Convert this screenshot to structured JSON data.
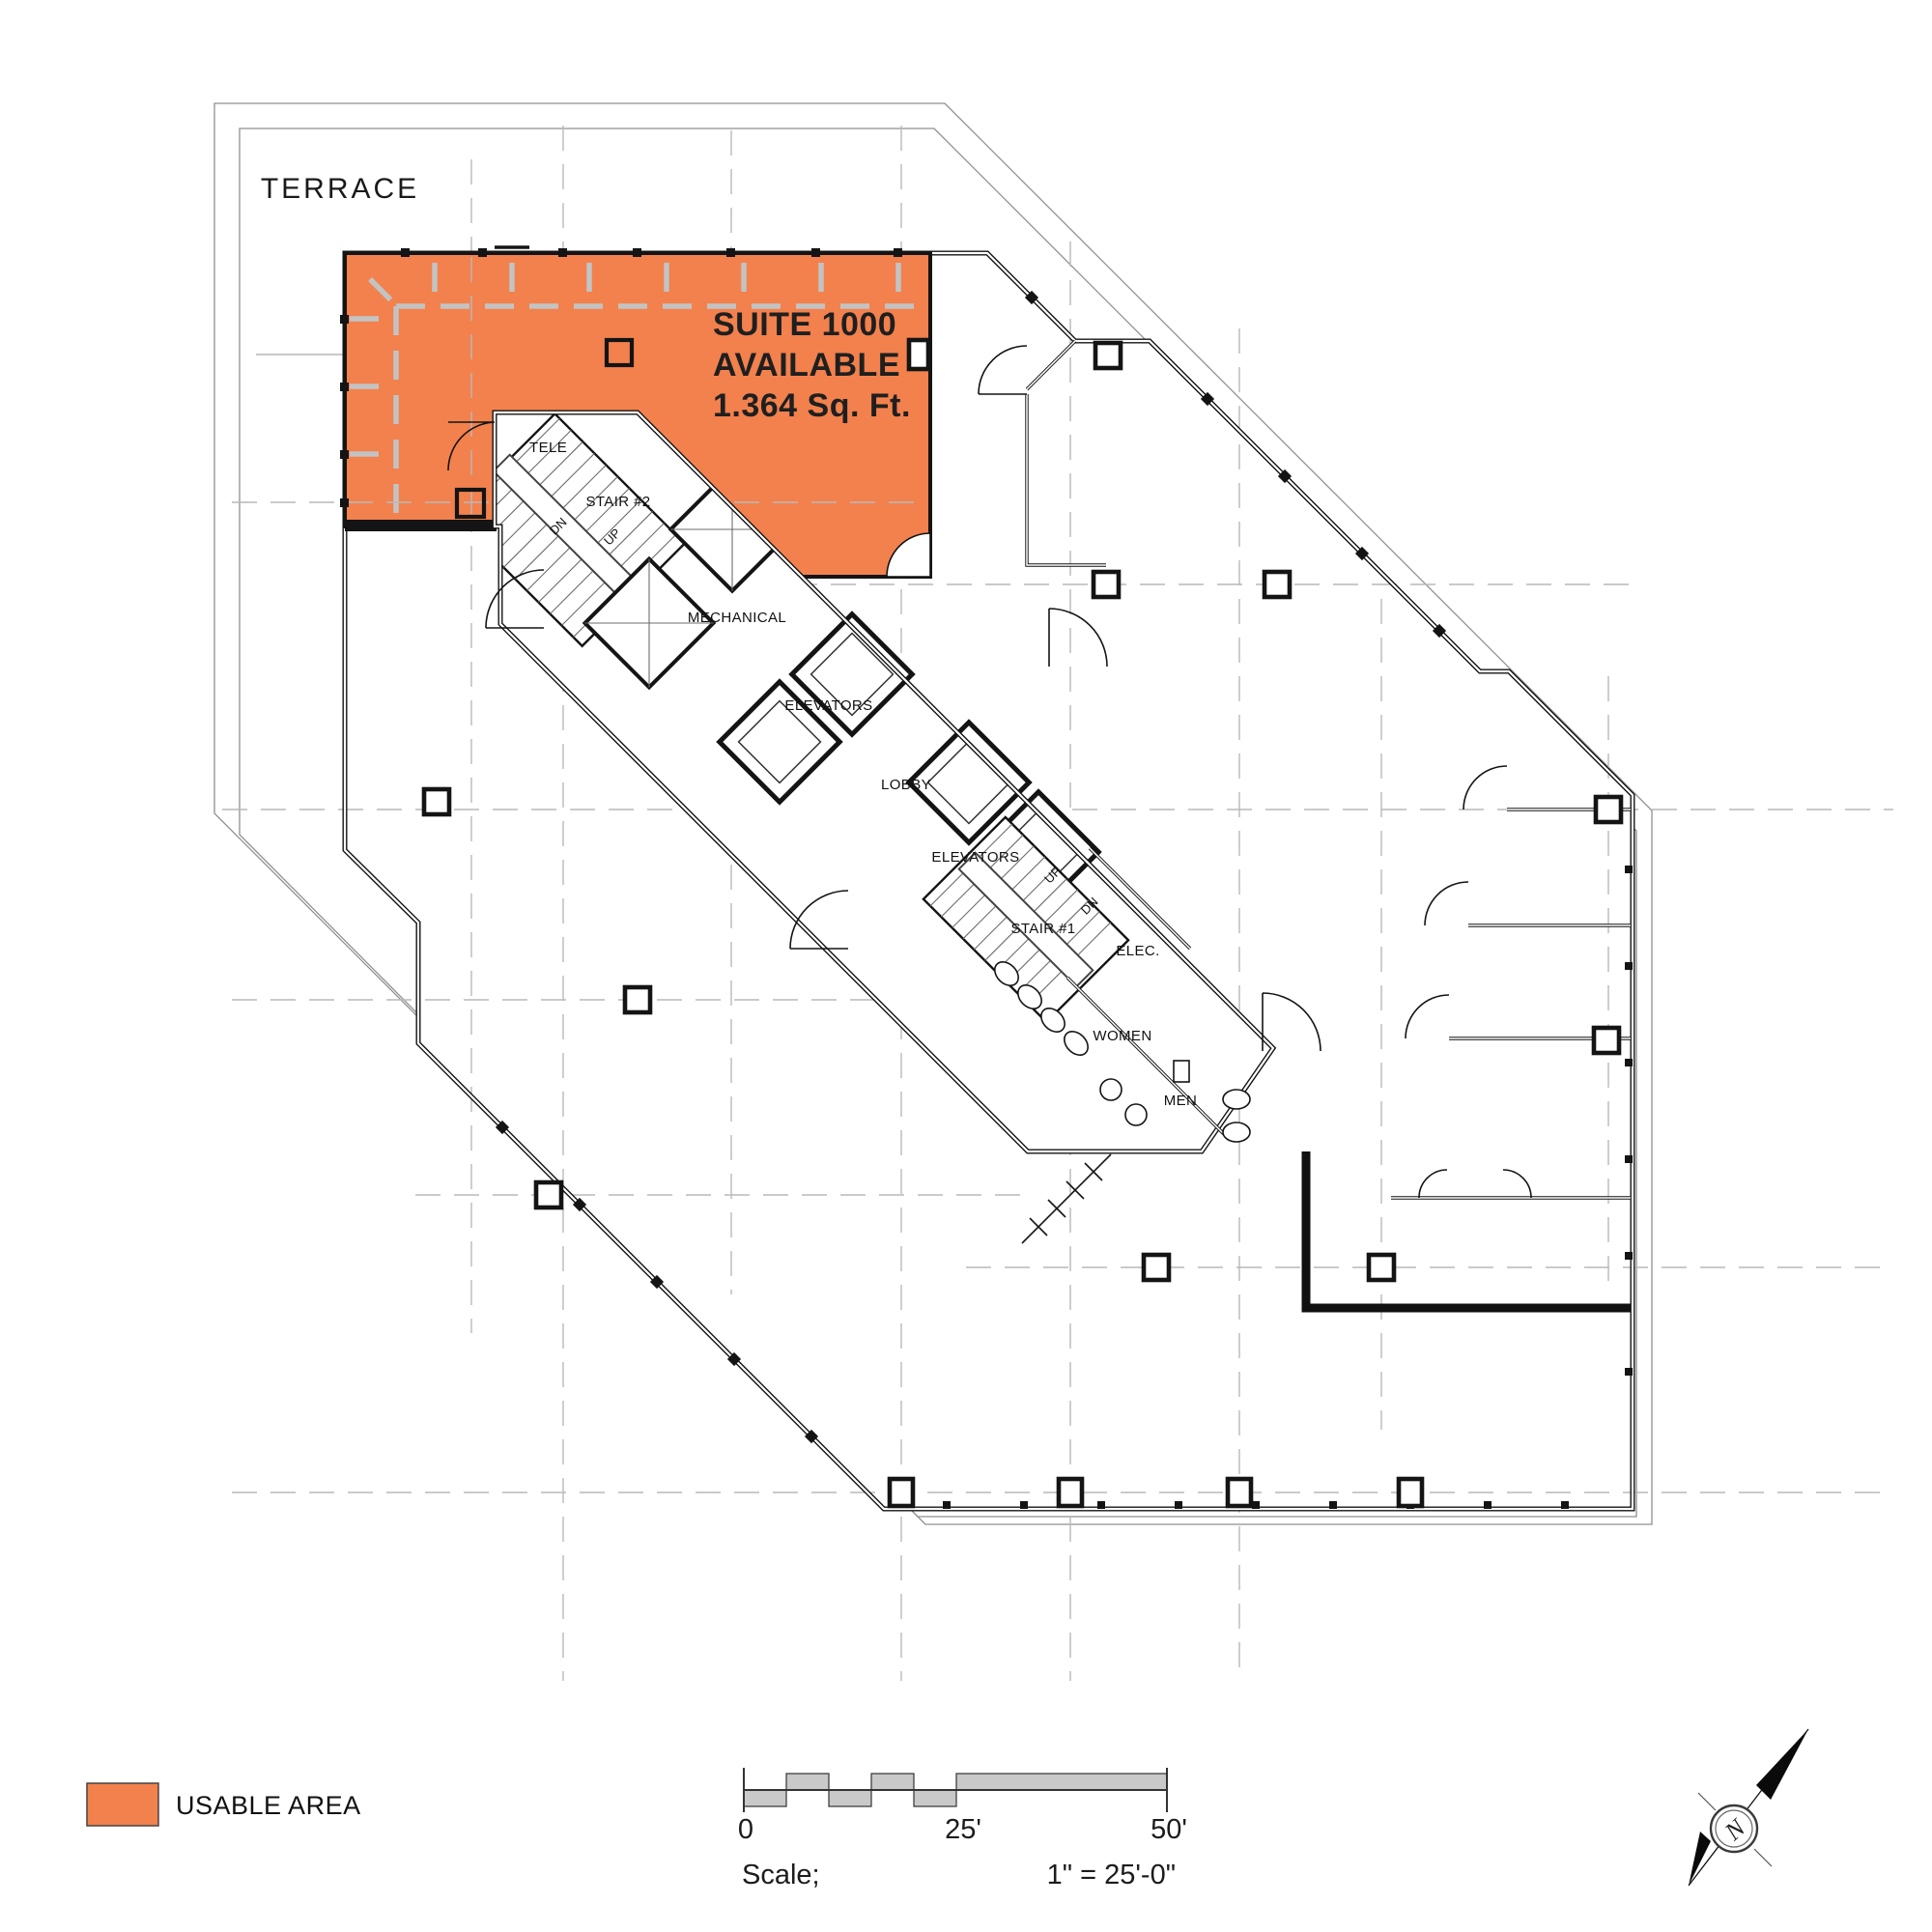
{
  "plan": {
    "terrace_label": "TERRACE",
    "suite": {
      "name": "SUITE 1000",
      "status": "AVAILABLE",
      "area": "1.364 Sq. Ft."
    },
    "rooms": {
      "tele": "TELE",
      "stair2": "STAIR #2",
      "stair2_dn": "DN",
      "stair2_up": "UP",
      "mechanical": "MECHANICAL",
      "elevators_upper": "ELEVATORS",
      "lobby": "LOBBY",
      "elevators_lower": "ELEVATORS",
      "stair1_up": "UP",
      "stair1_dn": "DN",
      "stair1": "STAIR #1",
      "elec": "ELEC.",
      "women": "WOMEN",
      "men": "MEN"
    }
  },
  "legend": {
    "usable_area_label": "USABLE AREA",
    "usable_area_color": "#F2814D"
  },
  "scale_bar": {
    "zero": "0",
    "mid": "25'",
    "end": "50'",
    "label": "Scale;",
    "ratio": "1\" = 25'-0\""
  },
  "compass": {
    "north": "N"
  },
  "colors": {
    "usable_area": "#F2814D",
    "wall": "#141414",
    "grid": "#b9b9b9"
  }
}
